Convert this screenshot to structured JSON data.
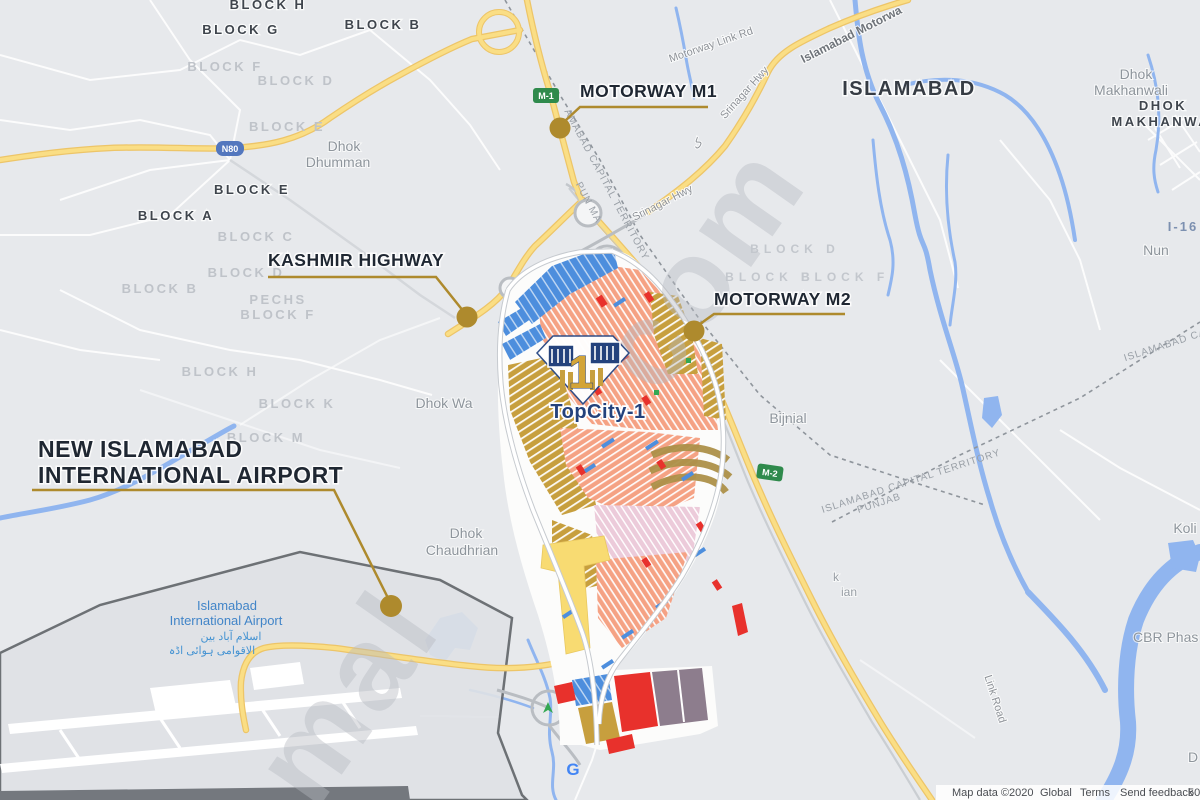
{
  "app": {
    "title": "TopCity-1 location map"
  },
  "colors": {
    "background": "#e7e9ec",
    "road_yellow": "#fade85",
    "road_yellow_casing": "#edc568",
    "water_blue": "#90b5ef",
    "callout_gold": "#ae8a2d",
    "callout_text": "#1f2732",
    "society_salmon": "#f5a284",
    "society_gold": "#c79f3e",
    "society_blue": "#4d8edd",
    "society_red": "#e8312c",
    "society_pink": "#eccbda",
    "society_purple": "#8d7d8d",
    "society_yellow": "#f8db72",
    "logo_navy": "#24427c",
    "airport_outline": "#606469"
  },
  "callouts": {
    "m1": {
      "label": "MOTORWAY M1"
    },
    "kashmir": {
      "label": "KASHMIR HIGHWAY"
    },
    "m2": {
      "label": "MOTORWAY M2"
    },
    "airport": {
      "line1": "NEW ISLAMABAD",
      "line2": "INTERNATIONAL AIRPORT"
    }
  },
  "shields": {
    "n80": "N80",
    "m1": "M-1",
    "m2": "M-2"
  },
  "topcity": {
    "name": "TopCity-1",
    "logo_one": "1"
  },
  "airport_label": {
    "line1": "Islamabad",
    "line2": "International Airport",
    "urdu1": "اسلام آباد بین",
    "urdu2": "الاقوامی ہوائی اڈہ"
  },
  "map_labels": [
    {
      "text": "BLOCK H"
    },
    {
      "text": "BLOCK G"
    },
    {
      "text": "BLOCK F"
    },
    {
      "text": "BLOCK D"
    },
    {
      "text": "BLOCK E"
    },
    {
      "text": "Dhok"
    },
    {
      "text": "Dhumman"
    },
    {
      "text": "BLOCK E"
    },
    {
      "text": "BLOCK A"
    },
    {
      "text": "BLOCK C"
    },
    {
      "text": "BLOCK D"
    },
    {
      "text": "BLOCK B"
    },
    {
      "text": "PECHS"
    },
    {
      "text": "BLOCK F"
    },
    {
      "text": "BLOCK B"
    },
    {
      "text": "BLOCK H"
    },
    {
      "text": "BLOCK K"
    },
    {
      "text": "BLOCK M"
    },
    {
      "text": "BLOCK D"
    },
    {
      "text": "BLOCK B"
    },
    {
      "text": "BLOCK F"
    },
    {
      "text": "Bijnial"
    },
    {
      "text": "ISLAMABAD"
    },
    {
      "text": "Dhok"
    },
    {
      "text": "Makhanwali"
    },
    {
      "text": "DHOK"
    },
    {
      "text": "MAKHANWAL"
    },
    {
      "text": "I-16"
    },
    {
      "text": "Nun"
    },
    {
      "text": "Koli"
    },
    {
      "text": "CBR Phas"
    },
    {
      "text": "D"
    },
    {
      "text": "k"
    },
    {
      "text": "ian"
    },
    {
      "text": "Dhok"
    },
    {
      "text": "Chaudhrian"
    },
    {
      "text": "Dhok Wa"
    },
    {
      "text": "Link Road"
    },
    {
      "text": "Motorway Link Rd"
    },
    {
      "text": "Srinagar Hwy"
    },
    {
      "text": "Srinagar Hwy"
    },
    {
      "text": "Islamabad Motorwa"
    },
    {
      "text": "AMABAD CAPITAL TERRITORY"
    },
    {
      "text": "PUN MA"
    },
    {
      "text": "ISLAMABAD CAPITAL TERRITORY"
    },
    {
      "text": "PUNJAB"
    },
    {
      "text": "ISLAMABAD CA"
    },
    {
      "text": "G"
    },
    {
      "text": "ک"
    }
  ],
  "watermark": {
    "frag1": "mal",
    "frag2": "com"
  },
  "attribution": {
    "map_data": "Map data ©2020",
    "provider": "Global",
    "terms": "Terms",
    "feedback": "Send feedback",
    "scale": "500 m"
  }
}
